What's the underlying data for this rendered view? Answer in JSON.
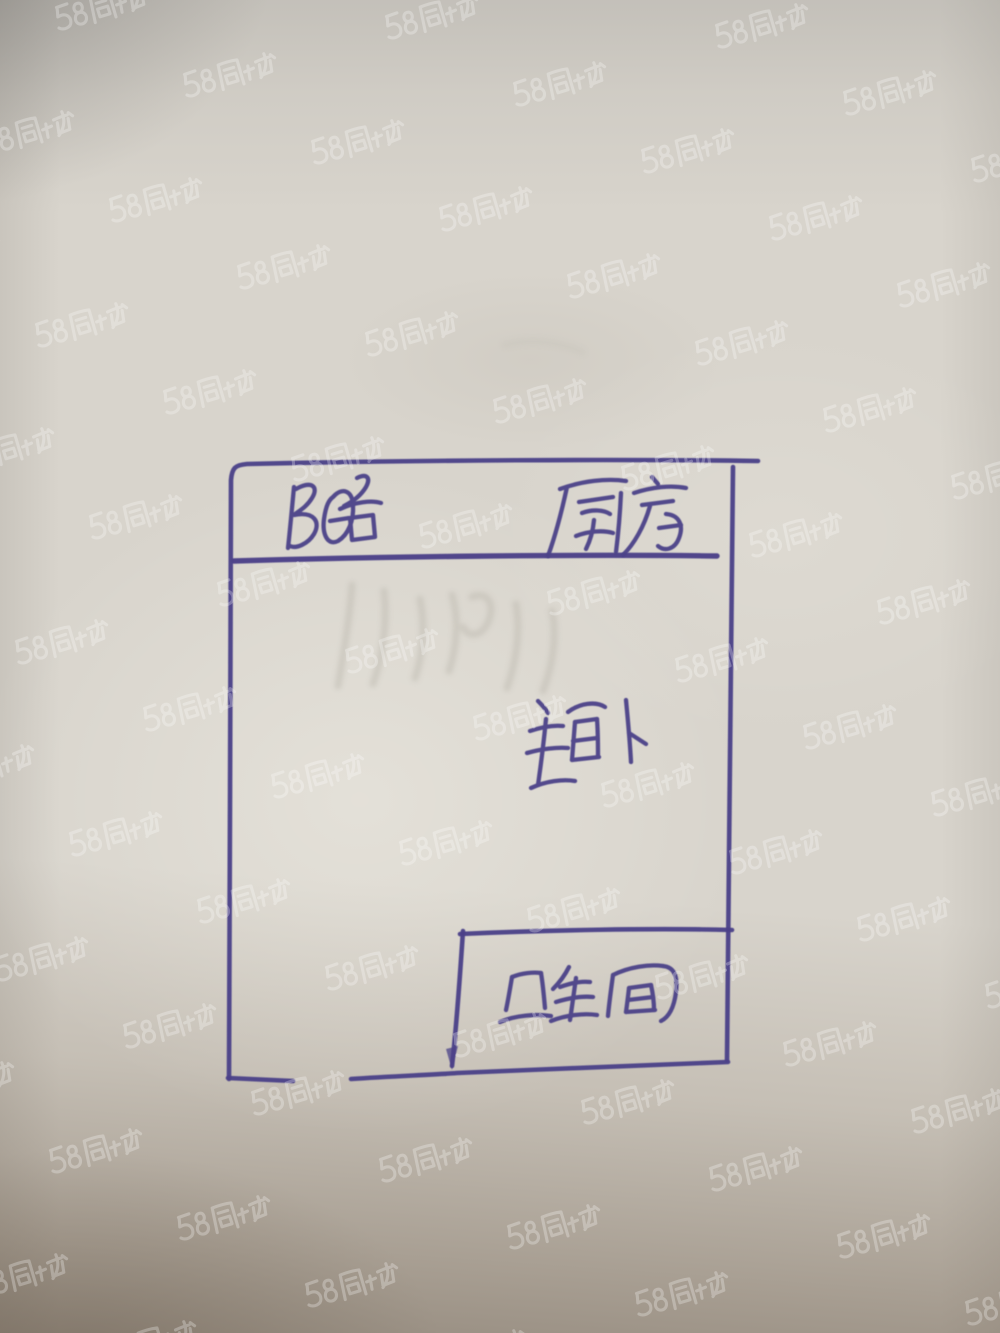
{
  "watermark": {
    "text": "58同城",
    "color": "#ffffff",
    "opacity": 0.27,
    "rotation_deg": -14
  },
  "sketch": {
    "pen_color": "#4b4288",
    "paper_color": "#d8d4cc",
    "rooms": [
      {
        "id": "balcony",
        "label": "阳台"
      },
      {
        "id": "kitchen",
        "label": "厨房"
      },
      {
        "id": "master-bedroom",
        "label": "主卧"
      },
      {
        "id": "bathroom",
        "label": "卫生间"
      }
    ]
  }
}
